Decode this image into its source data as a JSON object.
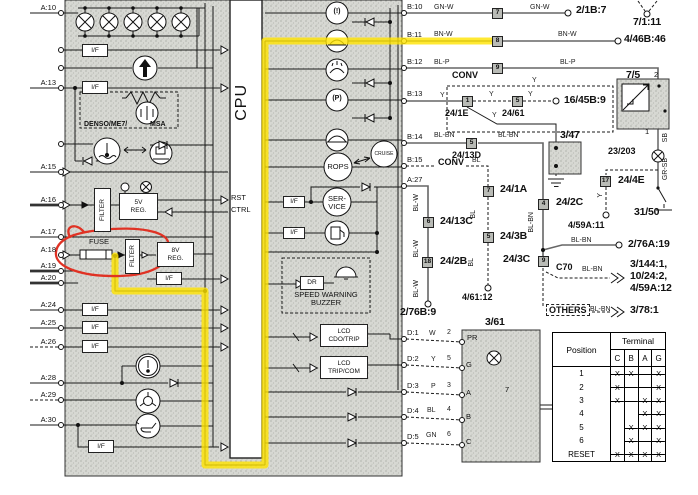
{
  "cpu_label": "CPU",
  "annotations": {
    "highlight_color": "#ffe400",
    "marker_color": "#e03224"
  },
  "terminal_table": {
    "position_header": "Position",
    "terminal_header": "Terminal",
    "cols": [
      "C",
      "B",
      "A",
      "G"
    ],
    "rows": [
      {
        "pos": "1",
        "marks": [
          "X",
          "X",
          "-",
          "X"
        ]
      },
      {
        "pos": "2",
        "marks": [
          "X",
          "-",
          "-",
          "X"
        ]
      },
      {
        "pos": "3",
        "marks": [
          "X",
          "-",
          "X",
          "X"
        ]
      },
      {
        "pos": "4",
        "marks": [
          "",
          "",
          "X",
          "X"
        ]
      },
      {
        "pos": "5",
        "marks": [
          "",
          "X",
          "X",
          "X"
        ]
      },
      {
        "pos": "6",
        "marks": [
          "",
          "X",
          "-",
          "X"
        ]
      },
      {
        "pos": "RESET",
        "marks": [
          "X",
          "X",
          "X",
          "X"
        ]
      }
    ]
  },
  "labels": [
    {
      "name": "pin-a10",
      "text": "A:10",
      "x": 28,
      "y": 4,
      "cls": "pin pr"
    },
    {
      "name": "pin-a13",
      "text": "A:13",
      "x": 28,
      "y": 79,
      "cls": "pin pr"
    },
    {
      "name": "pin-a15",
      "text": "A:15",
      "x": 28,
      "y": 163,
      "cls": "pin pr"
    },
    {
      "name": "pin-a16",
      "text": "A:16",
      "x": 28,
      "y": 196,
      "cls": "pin pr"
    },
    {
      "name": "pin-a17",
      "text": "A:17",
      "x": 28,
      "y": 228,
      "cls": "pin pr"
    },
    {
      "name": "pin-a18",
      "text": "A:18",
      "x": 28,
      "y": 246,
      "cls": "pin pr"
    },
    {
      "name": "pin-a19",
      "text": "A:19",
      "x": 28,
      "y": 262,
      "cls": "pin pr"
    },
    {
      "name": "pin-a20",
      "text": "A:20",
      "x": 28,
      "y": 274,
      "cls": "pin pr"
    },
    {
      "name": "pin-a24",
      "text": "A:24",
      "x": 28,
      "y": 301,
      "cls": "pin pr"
    },
    {
      "name": "pin-a25",
      "text": "A:25",
      "x": 28,
      "y": 319,
      "cls": "pin pr"
    },
    {
      "name": "pin-a26",
      "text": "A:26",
      "x": 28,
      "y": 338,
      "cls": "pin pr"
    },
    {
      "name": "pin-a28",
      "text": "A:28",
      "x": 28,
      "y": 374,
      "cls": "pin pr"
    },
    {
      "name": "pin-a29",
      "text": "A:29",
      "x": 28,
      "y": 391,
      "cls": "pin pr"
    },
    {
      "name": "pin-a30",
      "text": "A:30",
      "x": 28,
      "y": 416,
      "cls": "pin pr"
    },
    {
      "name": "pin-b10",
      "text": "B:10",
      "x": 407,
      "y": 3,
      "cls": "pin"
    },
    {
      "name": "pin-b11",
      "text": "B:11",
      "x": 407,
      "y": 31,
      "cls": "pin"
    },
    {
      "name": "pin-b12",
      "text": "B:12",
      "x": 407,
      "y": 58,
      "cls": "pin"
    },
    {
      "name": "pin-b13",
      "text": "B:13",
      "x": 407,
      "y": 90,
      "cls": "pin"
    },
    {
      "name": "pin-b14",
      "text": "B:14",
      "x": 407,
      "y": 133,
      "cls": "pin"
    },
    {
      "name": "pin-b15",
      "text": "B:15",
      "x": 407,
      "y": 156,
      "cls": "pin"
    },
    {
      "name": "pin-a27",
      "text": "A:27",
      "x": 407,
      "y": 176,
      "cls": "pin"
    },
    {
      "name": "pin-d1",
      "text": "D:1",
      "x": 407,
      "y": 329,
      "cls": "pin"
    },
    {
      "name": "pin-d2",
      "text": "D:2",
      "x": 407,
      "y": 355,
      "cls": "pin"
    },
    {
      "name": "pin-d3",
      "text": "D:3",
      "x": 407,
      "y": 382,
      "cls": "pin"
    },
    {
      "name": "pin-d4",
      "text": "D:4",
      "x": 407,
      "y": 407,
      "cls": "pin"
    },
    {
      "name": "pin-d5",
      "text": "D:5",
      "x": 407,
      "y": 433,
      "cls": "pin"
    },
    {
      "name": "wire-gnw-1",
      "text": "GN-W",
      "x": 434,
      "y": 4,
      "cls": "wire"
    },
    {
      "name": "wire-gnw-2",
      "text": "GN-W",
      "x": 530,
      "y": 4,
      "cls": "wire"
    },
    {
      "name": "ref-21b7",
      "text": "2/1B:7",
      "x": 576,
      "y": 5,
      "cls": "ref"
    },
    {
      "name": "ref-7111",
      "text": "7/1:11",
      "x": 633,
      "y": 17,
      "cls": "ref"
    },
    {
      "name": "wire-bnw-1",
      "text": "BN-W",
      "x": 434,
      "y": 31,
      "cls": "wire"
    },
    {
      "name": "wire-bnw-2",
      "text": "BN-W",
      "x": 558,
      "y": 31,
      "cls": "wire"
    },
    {
      "name": "ref-446b46",
      "text": "4/46B:46",
      "x": 624,
      "y": 34,
      "cls": "ref"
    },
    {
      "name": "wire-blp-1",
      "text": "BL-P",
      "x": 434,
      "y": 59,
      "cls": "wire"
    },
    {
      "name": "wire-blp-2",
      "text": "BL-P",
      "x": 560,
      "y": 59,
      "cls": "wire"
    },
    {
      "name": "conv-label-1",
      "text": "CONV",
      "x": 452,
      "y": 70,
      "cls": "refmd"
    },
    {
      "name": "ref-75",
      "text": "7/5",
      "x": 626,
      "y": 70,
      "cls": "ref"
    },
    {
      "name": "pin-75-2",
      "text": "2",
      "x": 654,
      "y": 71,
      "cls": "pin"
    },
    {
      "name": "pin-75-1",
      "text": "1",
      "x": 645,
      "y": 128,
      "cls": "pin"
    },
    {
      "name": "wire-y-1",
      "text": "Y",
      "x": 440,
      "y": 92,
      "cls": "wire"
    },
    {
      "name": "connector-1-24-1e",
      "text": "1",
      "x": 462,
      "y": 96,
      "cls": "conn"
    },
    {
      "name": "ref-241e",
      "text": "24/1E",
      "x": 445,
      "y": 108,
      "cls": "refmd"
    },
    {
      "name": "wire-y-2",
      "text": "Y",
      "x": 489,
      "y": 91,
      "cls": "wire"
    },
    {
      "name": "connector-5-24-61",
      "text": "5",
      "x": 512,
      "y": 96,
      "cls": "conn"
    },
    {
      "name": "ref-2461",
      "text": "24/61",
      "x": 502,
      "y": 108,
      "cls": "refmd"
    },
    {
      "name": "wire-y-3",
      "text": "Y",
      "x": 528,
      "y": 91,
      "cls": "wire"
    },
    {
      "name": "wire-y-4",
      "text": "Y",
      "x": 532,
      "y": 77,
      "cls": "wire"
    },
    {
      "name": "ref-1645b9",
      "text": "16/45B:9",
      "x": 564,
      "y": 95,
      "cls": "ref"
    },
    {
      "name": "wire-y-5",
      "text": "Y",
      "x": 492,
      "y": 112,
      "cls": "wire"
    },
    {
      "name": "ref-347",
      "text": "3/47",
      "x": 560,
      "y": 130,
      "cls": "ref"
    },
    {
      "name": "wire-blbn-1",
      "text": "BL-BN",
      "x": 434,
      "y": 132,
      "cls": "wire"
    },
    {
      "name": "connector-5-24-13d",
      "text": "5",
      "x": 466,
      "y": 138,
      "cls": "conn"
    },
    {
      "name": "ref-2413d",
      "text": "24/13D",
      "x": 452,
      "y": 150,
      "cls": "refmd"
    },
    {
      "name": "wire-blbn-2",
      "text": "BL-BN",
      "x": 498,
      "y": 132,
      "cls": "wire"
    },
    {
      "name": "wire-sb",
      "text": "SB",
      "x": 662,
      "y": 133,
      "cls": "wireV"
    },
    {
      "name": "ref-23203",
      "text": "23/203",
      "x": 608,
      "y": 146,
      "cls": "refmd"
    },
    {
      "name": "wire-grsb",
      "text": "GR-SB",
      "x": 662,
      "y": 158,
      "cls": "wireV"
    },
    {
      "name": "connector-17-24-4e",
      "text": "17",
      "x": 600,
      "y": 176,
      "cls": "conn"
    },
    {
      "name": "ref-244e",
      "text": "24/4E",
      "x": 618,
      "y": 175,
      "cls": "ref"
    },
    {
      "name": "wire-y-6",
      "text": "Y",
      "x": 597,
      "y": 193,
      "cls": "wireV"
    },
    {
      "name": "ref-459a11",
      "text": "4/59A:11",
      "x": 568,
      "y": 220,
      "cls": "refmd"
    },
    {
      "name": "ref-3150",
      "text": "31/50",
      "x": 634,
      "y": 207,
      "cls": "ref"
    },
    {
      "name": "conv-label-2",
      "text": "CONV",
      "x": 438,
      "y": 157,
      "cls": "refmd"
    },
    {
      "name": "wire-bl-1",
      "text": "BL",
      "x": 472,
      "y": 157,
      "cls": "wire"
    },
    {
      "name": "connector-7-24-1a",
      "text": "7",
      "x": 483,
      "y": 186,
      "cls": "conn"
    },
    {
      "name": "ref-241a",
      "text": "24/1A",
      "x": 500,
      "y": 184,
      "cls": "ref"
    },
    {
      "name": "wire-blw-1",
      "text": "BL-W",
      "x": 413,
      "y": 194,
      "cls": "wireV"
    },
    {
      "name": "connector-6-24-13c",
      "text": "6",
      "x": 423,
      "y": 217,
      "cls": "conn"
    },
    {
      "name": "ref-2413c",
      "text": "24/13C",
      "x": 440,
      "y": 216,
      "cls": "ref"
    },
    {
      "name": "connector-4-24-2c",
      "text": "4",
      "x": 538,
      "y": 199,
      "cls": "conn"
    },
    {
      "name": "ref-242c",
      "text": "24/2C",
      "x": 556,
      "y": 197,
      "cls": "ref"
    },
    {
      "name": "wire-blbn-v",
      "text": "BL-BN",
      "x": 528,
      "y": 212,
      "cls": "wireV"
    },
    {
      "name": "wire-blw-2",
      "text": "BL-W",
      "x": 413,
      "y": 240,
      "cls": "wireV"
    },
    {
      "name": "connector-18-24-2b",
      "text": "18",
      "x": 422,
      "y": 257,
      "cls": "conn"
    },
    {
      "name": "ref-242b",
      "text": "24/2B",
      "x": 440,
      "y": 256,
      "cls": "ref"
    },
    {
      "name": "wire-bl-2",
      "text": "BL",
      "x": 470,
      "y": 210,
      "cls": "wireV"
    },
    {
      "name": "connector-5-24-3b",
      "text": "5",
      "x": 483,
      "y": 232,
      "cls": "conn"
    },
    {
      "name": "ref-243b",
      "text": "24/3B",
      "x": 500,
      "y": 231,
      "cls": "ref"
    },
    {
      "name": "ref-243c",
      "text": "24/3C",
      "x": 503,
      "y": 254,
      "cls": "ref"
    },
    {
      "name": "connector-9-24-3c",
      "text": "9",
      "x": 538,
      "y": 256,
      "cls": "conn"
    },
    {
      "name": "wire-blbn-3",
      "text": "BL-BN",
      "x": 571,
      "y": 237,
      "cls": "wire"
    },
    {
      "name": "ref-276a19",
      "text": "2/76A:19",
      "x": 628,
      "y": 239,
      "cls": "ref"
    },
    {
      "name": "ref-c70",
      "text": "C70",
      "x": 556,
      "y": 262,
      "cls": "refmd"
    },
    {
      "name": "wire-blbn-4",
      "text": "BL-BN",
      "x": 582,
      "y": 266,
      "cls": "wire"
    },
    {
      "name": "ref-3144-1",
      "text": "3/144:1,",
      "x": 630,
      "y": 259,
      "cls": "ref"
    },
    {
      "name": "ref-1024-2",
      "text": "10/24:2,",
      "x": 630,
      "y": 271,
      "cls": "ref"
    },
    {
      "name": "ref-459a12",
      "text": "4/59A:12",
      "x": 630,
      "y": 283,
      "cls": "ref"
    },
    {
      "name": "wire-bl-3",
      "text": "BL",
      "x": 468,
      "y": 258,
      "cls": "wireV"
    },
    {
      "name": "ref-46112",
      "text": "4/61:12",
      "x": 462,
      "y": 292,
      "cls": "refmd"
    },
    {
      "name": "wire-blw-3",
      "text": "BL-W",
      "x": 413,
      "y": 280,
      "cls": "wireV"
    },
    {
      "name": "ref-276b9",
      "text": "2/76B:9",
      "x": 400,
      "y": 307,
      "cls": "ref"
    },
    {
      "name": "ref-others",
      "text": "OTHERS",
      "x": 546,
      "y": 304,
      "cls": "refmd dash"
    },
    {
      "name": "wire-blbn-5",
      "text": "BL-BN",
      "x": 590,
      "y": 306,
      "cls": "wire"
    },
    {
      "name": "ref-3781",
      "text": "3/78:1",
      "x": 630,
      "y": 305,
      "cls": "ref"
    },
    {
      "name": "ref-361",
      "text": "3/61",
      "x": 485,
      "y": 317,
      "cls": "ref"
    },
    {
      "name": "connector-7-b10",
      "text": "7",
      "x": 492,
      "y": 8,
      "cls": "conn"
    },
    {
      "name": "connector-8-b11",
      "text": "8",
      "x": 492,
      "y": 36,
      "cls": "conn"
    },
    {
      "name": "connector-9-b12",
      "text": "9",
      "x": 492,
      "y": 63,
      "cls": "conn"
    },
    {
      "name": "cpu-title",
      "text": "CPU",
      "x": 233,
      "y": 84,
      "cls": "cpu"
    },
    {
      "name": "rst-label",
      "text": "RST",
      "x": 231,
      "y": 194,
      "cls": "pin"
    },
    {
      "name": "ctrl-label",
      "text": "CTRL",
      "x": 231,
      "y": 206,
      "cls": "pin"
    },
    {
      "name": "if-box-1",
      "text": "I/F",
      "x": 82,
      "y": 44,
      "cls": "box",
      "w": 26,
      "h": 13
    },
    {
      "name": "if-box-2",
      "text": "I/F",
      "x": 82,
      "y": 81,
      "cls": "box",
      "w": 26,
      "h": 13
    },
    {
      "name": "if-box-3",
      "text": "I/F",
      "x": 156,
      "y": 272,
      "cls": "box",
      "w": 26,
      "h": 13
    },
    {
      "name": "if-box-4",
      "text": "I/F",
      "x": 82,
      "y": 303,
      "cls": "box",
      "w": 26,
      "h": 13
    },
    {
      "name": "if-box-5",
      "text": "I/F",
      "x": 82,
      "y": 321,
      "cls": "box",
      "w": 26,
      "h": 13
    },
    {
      "name": "if-box-6",
      "text": "I/F",
      "x": 82,
      "y": 340,
      "cls": "box",
      "w": 26,
      "h": 13
    },
    {
      "name": "if-box-7",
      "text": "I/F",
      "x": 88,
      "y": 440,
      "cls": "box",
      "w": 26,
      "h": 13
    },
    {
      "name": "if-box-8",
      "text": "I/F",
      "x": 283,
      "y": 196,
      "cls": "box",
      "w": 22,
      "h": 12
    },
    {
      "name": "if-box-9",
      "text": "I/F",
      "x": 283,
      "y": 227,
      "cls": "box",
      "w": 22,
      "h": 12
    },
    {
      "name": "filter-box-1",
      "text": "FILTER",
      "x": 94,
      "y": 188,
      "cls": "boxV",
      "w": 17,
      "h": 44
    },
    {
      "name": "filter-box-2",
      "text": "FILTER",
      "x": 125,
      "y": 239,
      "cls": "boxV",
      "w": 15,
      "h": 35
    },
    {
      "name": "reg-5v-box",
      "text": "5V\nREG.",
      "x": 119,
      "y": 193,
      "cls": "box",
      "w": 39,
      "h": 27
    },
    {
      "name": "reg-8v-box",
      "text": "8V\nREG.",
      "x": 157,
      "y": 242,
      "cls": "box",
      "w": 37,
      "h": 25
    },
    {
      "name": "fuse-label",
      "text": "FUSE",
      "x": 89,
      "y": 238,
      "cls": "pin"
    },
    {
      "name": "denso-label",
      "text": "DENSO/ME7/",
      "x": 84,
      "y": 121,
      "cls": "b7"
    },
    {
      "name": "msa-label",
      "text": "MSA",
      "x": 150,
      "y": 121,
      "cls": "b7"
    },
    {
      "name": "brake-warning-icon",
      "text": "(!)",
      "x": 330,
      "y": 8,
      "cls": "b7 ctr",
      "w": 14
    },
    {
      "name": "parking-brake-icon",
      "text": "(P)",
      "x": 329,
      "y": 95,
      "cls": "b7 ctr",
      "w": 16
    },
    {
      "name": "rops-label",
      "text": "ROPS",
      "x": 327,
      "y": 163,
      "cls": "pin ctr",
      "w": 22
    },
    {
      "name": "cruise-label",
      "text": "CRUISE",
      "x": 371,
      "y": 152,
      "cls": "tiny ctr",
      "w": 26
    },
    {
      "name": "service-label",
      "text": "SER-\nVICE",
      "x": 325,
      "y": 195,
      "cls": "ctr",
      "w": 24
    },
    {
      "name": "dr-box",
      "text": "DR",
      "x": 300,
      "y": 276,
      "cls": "box",
      "w": 24,
      "h": 14
    },
    {
      "name": "speed-warning-label",
      "text": "SPEED WARNING\nBUZZER",
      "x": 286,
      "y": 291,
      "cls": "ctr pin",
      "w": 80
    },
    {
      "name": "lcd-odo-box",
      "text": "LCD\nCDO/TRIP",
      "x": 320,
      "y": 324,
      "cls": "box",
      "w": 48,
      "h": 23
    },
    {
      "name": "lcd-trip-box",
      "text": "LCD\nTRIP/COM",
      "x": 320,
      "y": 356,
      "cls": "box",
      "w": 48,
      "h": 23
    },
    {
      "name": "wire-w",
      "text": "W",
      "x": 429,
      "y": 330,
      "cls": "wire"
    },
    {
      "name": "pin-361-2",
      "text": "2",
      "x": 447,
      "y": 329,
      "cls": "wire"
    },
    {
      "name": "wire-y-7",
      "text": "Y",
      "x": 431,
      "y": 356,
      "cls": "wire"
    },
    {
      "name": "pin-361-5",
      "text": "5",
      "x": 447,
      "y": 355,
      "cls": "wire"
    },
    {
      "name": "wire-p",
      "text": "P",
      "x": 431,
      "y": 383,
      "cls": "wire"
    },
    {
      "name": "pin-361-3",
      "text": "3",
      "x": 447,
      "y": 382,
      "cls": "wire"
    },
    {
      "name": "wire-bl-4",
      "text": "BL",
      "x": 427,
      "y": 407,
      "cls": "wire"
    },
    {
      "name": "pin-361-4",
      "text": "4",
      "x": 447,
      "y": 406,
      "cls": "wire"
    },
    {
      "name": "wire-gn",
      "text": "GN",
      "x": 426,
      "y": 432,
      "cls": "wire"
    },
    {
      "name": "pin-361-6",
      "text": "6",
      "x": 447,
      "y": 431,
      "cls": "wire"
    },
    {
      "name": "lamp-pr-label",
      "text": "PR",
      "x": 467,
      "y": 334,
      "cls": "pin"
    },
    {
      "name": "lamp-g-label",
      "text": "G",
      "x": 466,
      "y": 361,
      "cls": "pin"
    },
    {
      "name": "lamp-a-label",
      "text": "A",
      "x": 466,
      "y": 389,
      "cls": "pin"
    },
    {
      "name": "lamp-b-label",
      "text": "B",
      "x": 466,
      "y": 413,
      "cls": "pin"
    },
    {
      "name": "lamp-c-label",
      "text": "C",
      "x": 466,
      "y": 438,
      "cls": "pin"
    },
    {
      "name": "switch-361-7",
      "text": "7",
      "x": 505,
      "y": 386,
      "cls": "pin"
    }
  ]
}
